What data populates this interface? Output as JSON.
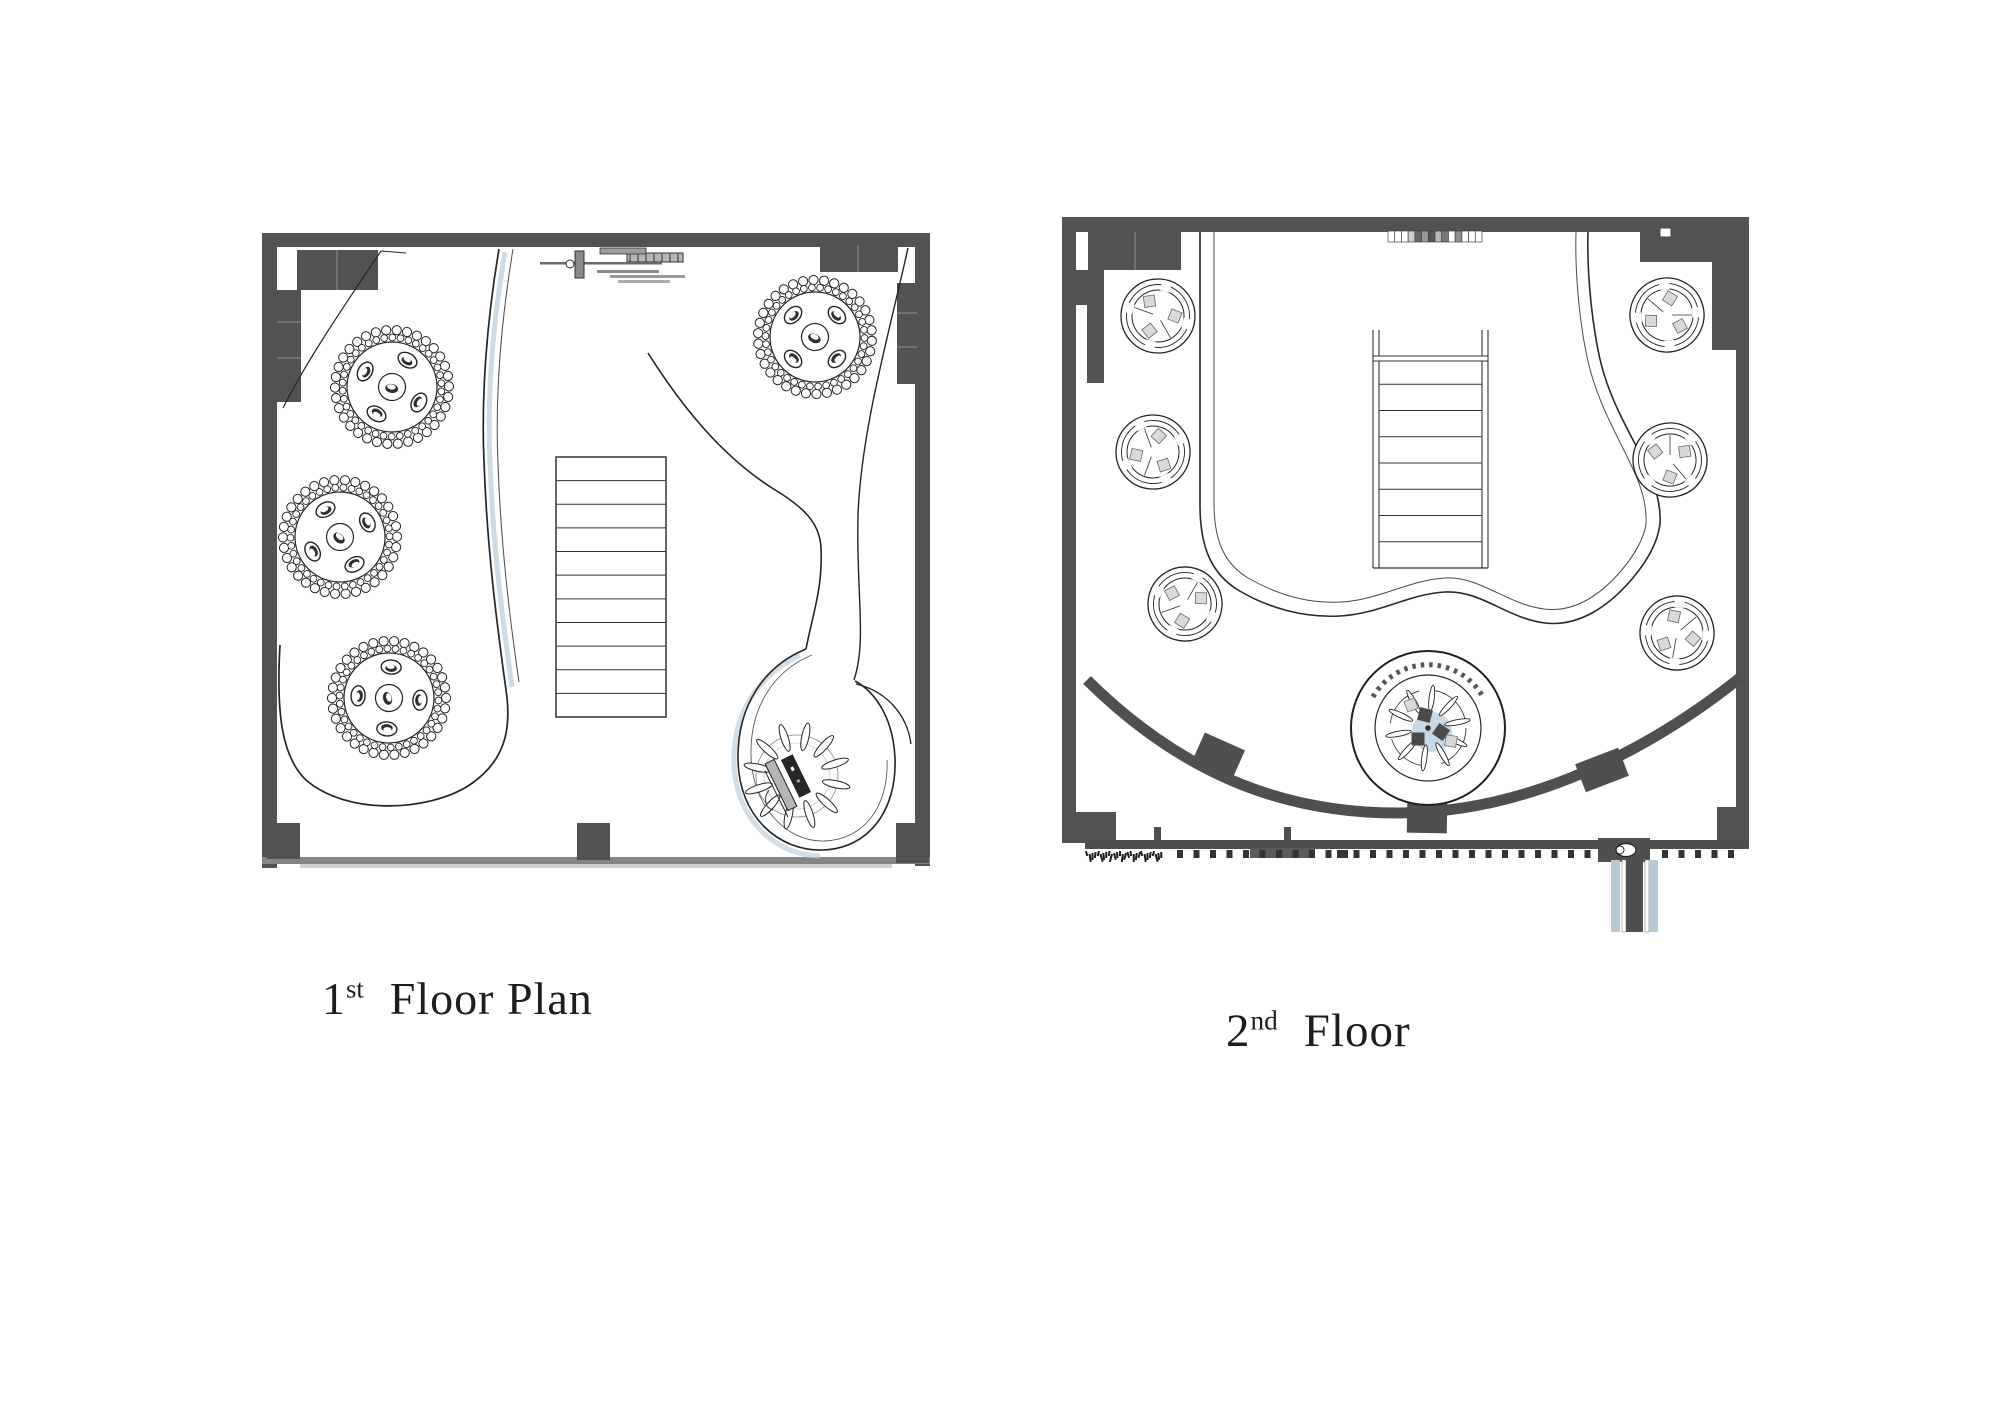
{
  "page": {
    "background": "#ffffff"
  },
  "labels": {
    "floor1": {
      "number": "1",
      "ordinal": "st",
      "text": "Floor Plan"
    },
    "floor2": {
      "number": "2",
      "ordinal": "nd",
      "text": "Floor"
    }
  },
  "colors": {
    "wall": "#525252",
    "wall_light": "#8a8a8a",
    "line": "#242424",
    "line_soft": "#555555",
    "accent_blue": "#c8d8e4",
    "shadow_blue": "#bfcfda",
    "light_gray": "#d9d9d9"
  },
  "floor1": {
    "tables": [
      {
        "cx": 392,
        "cy": 387,
        "rot": 10
      },
      {
        "cx": 340,
        "cy": 537,
        "rot": 42
      },
      {
        "cx": 389,
        "cy": 698,
        "rot": 74
      },
      {
        "cx": 815,
        "cy": 337,
        "rot": 25
      }
    ],
    "stairs": {
      "x": 556,
      "y": 457,
      "width": 110,
      "height": 260,
      "treads": 11
    },
    "sunburst": {
      "cx": 797,
      "cy": 776,
      "petals": 12
    }
  },
  "floor2": {
    "booths": [
      {
        "cx": 1158,
        "cy": 316,
        "rot": 0
      },
      {
        "cx": 1153,
        "cy": 452,
        "rot": 50
      },
      {
        "cx": 1185,
        "cy": 604,
        "rot": 100
      },
      {
        "cx": 1667,
        "cy": 315,
        "rot": 160
      },
      {
        "cx": 1670,
        "cy": 460,
        "rot": 210
      },
      {
        "cx": 1677,
        "cy": 633,
        "rot": 260
      }
    ],
    "stairs": {
      "x": 1379,
      "y": 358,
      "width": 103,
      "height": 210,
      "treads": 8
    },
    "spiral": {
      "cx": 1428,
      "cy": 728,
      "blades": 10
    },
    "shelf_cells": [
      "#ffffff",
      "#ffffff",
      "#ffffff",
      "#cfcfcf",
      "#6a6a6a",
      "#9a9a9a",
      "#555555",
      "#b5b5b5",
      "#777777",
      "#ffffff",
      "#8f8f8f",
      "#ffffff",
      "#ffffff",
      "#ffffff"
    ],
    "balusters": [
      {
        "from": 1177,
        "to": 1356,
        "step": 16.5
      },
      {
        "from": 1337,
        "to": 1597,
        "step": 16.5
      },
      {
        "from": 1662,
        "to": 1728,
        "step": 16.5
      }
    ]
  }
}
